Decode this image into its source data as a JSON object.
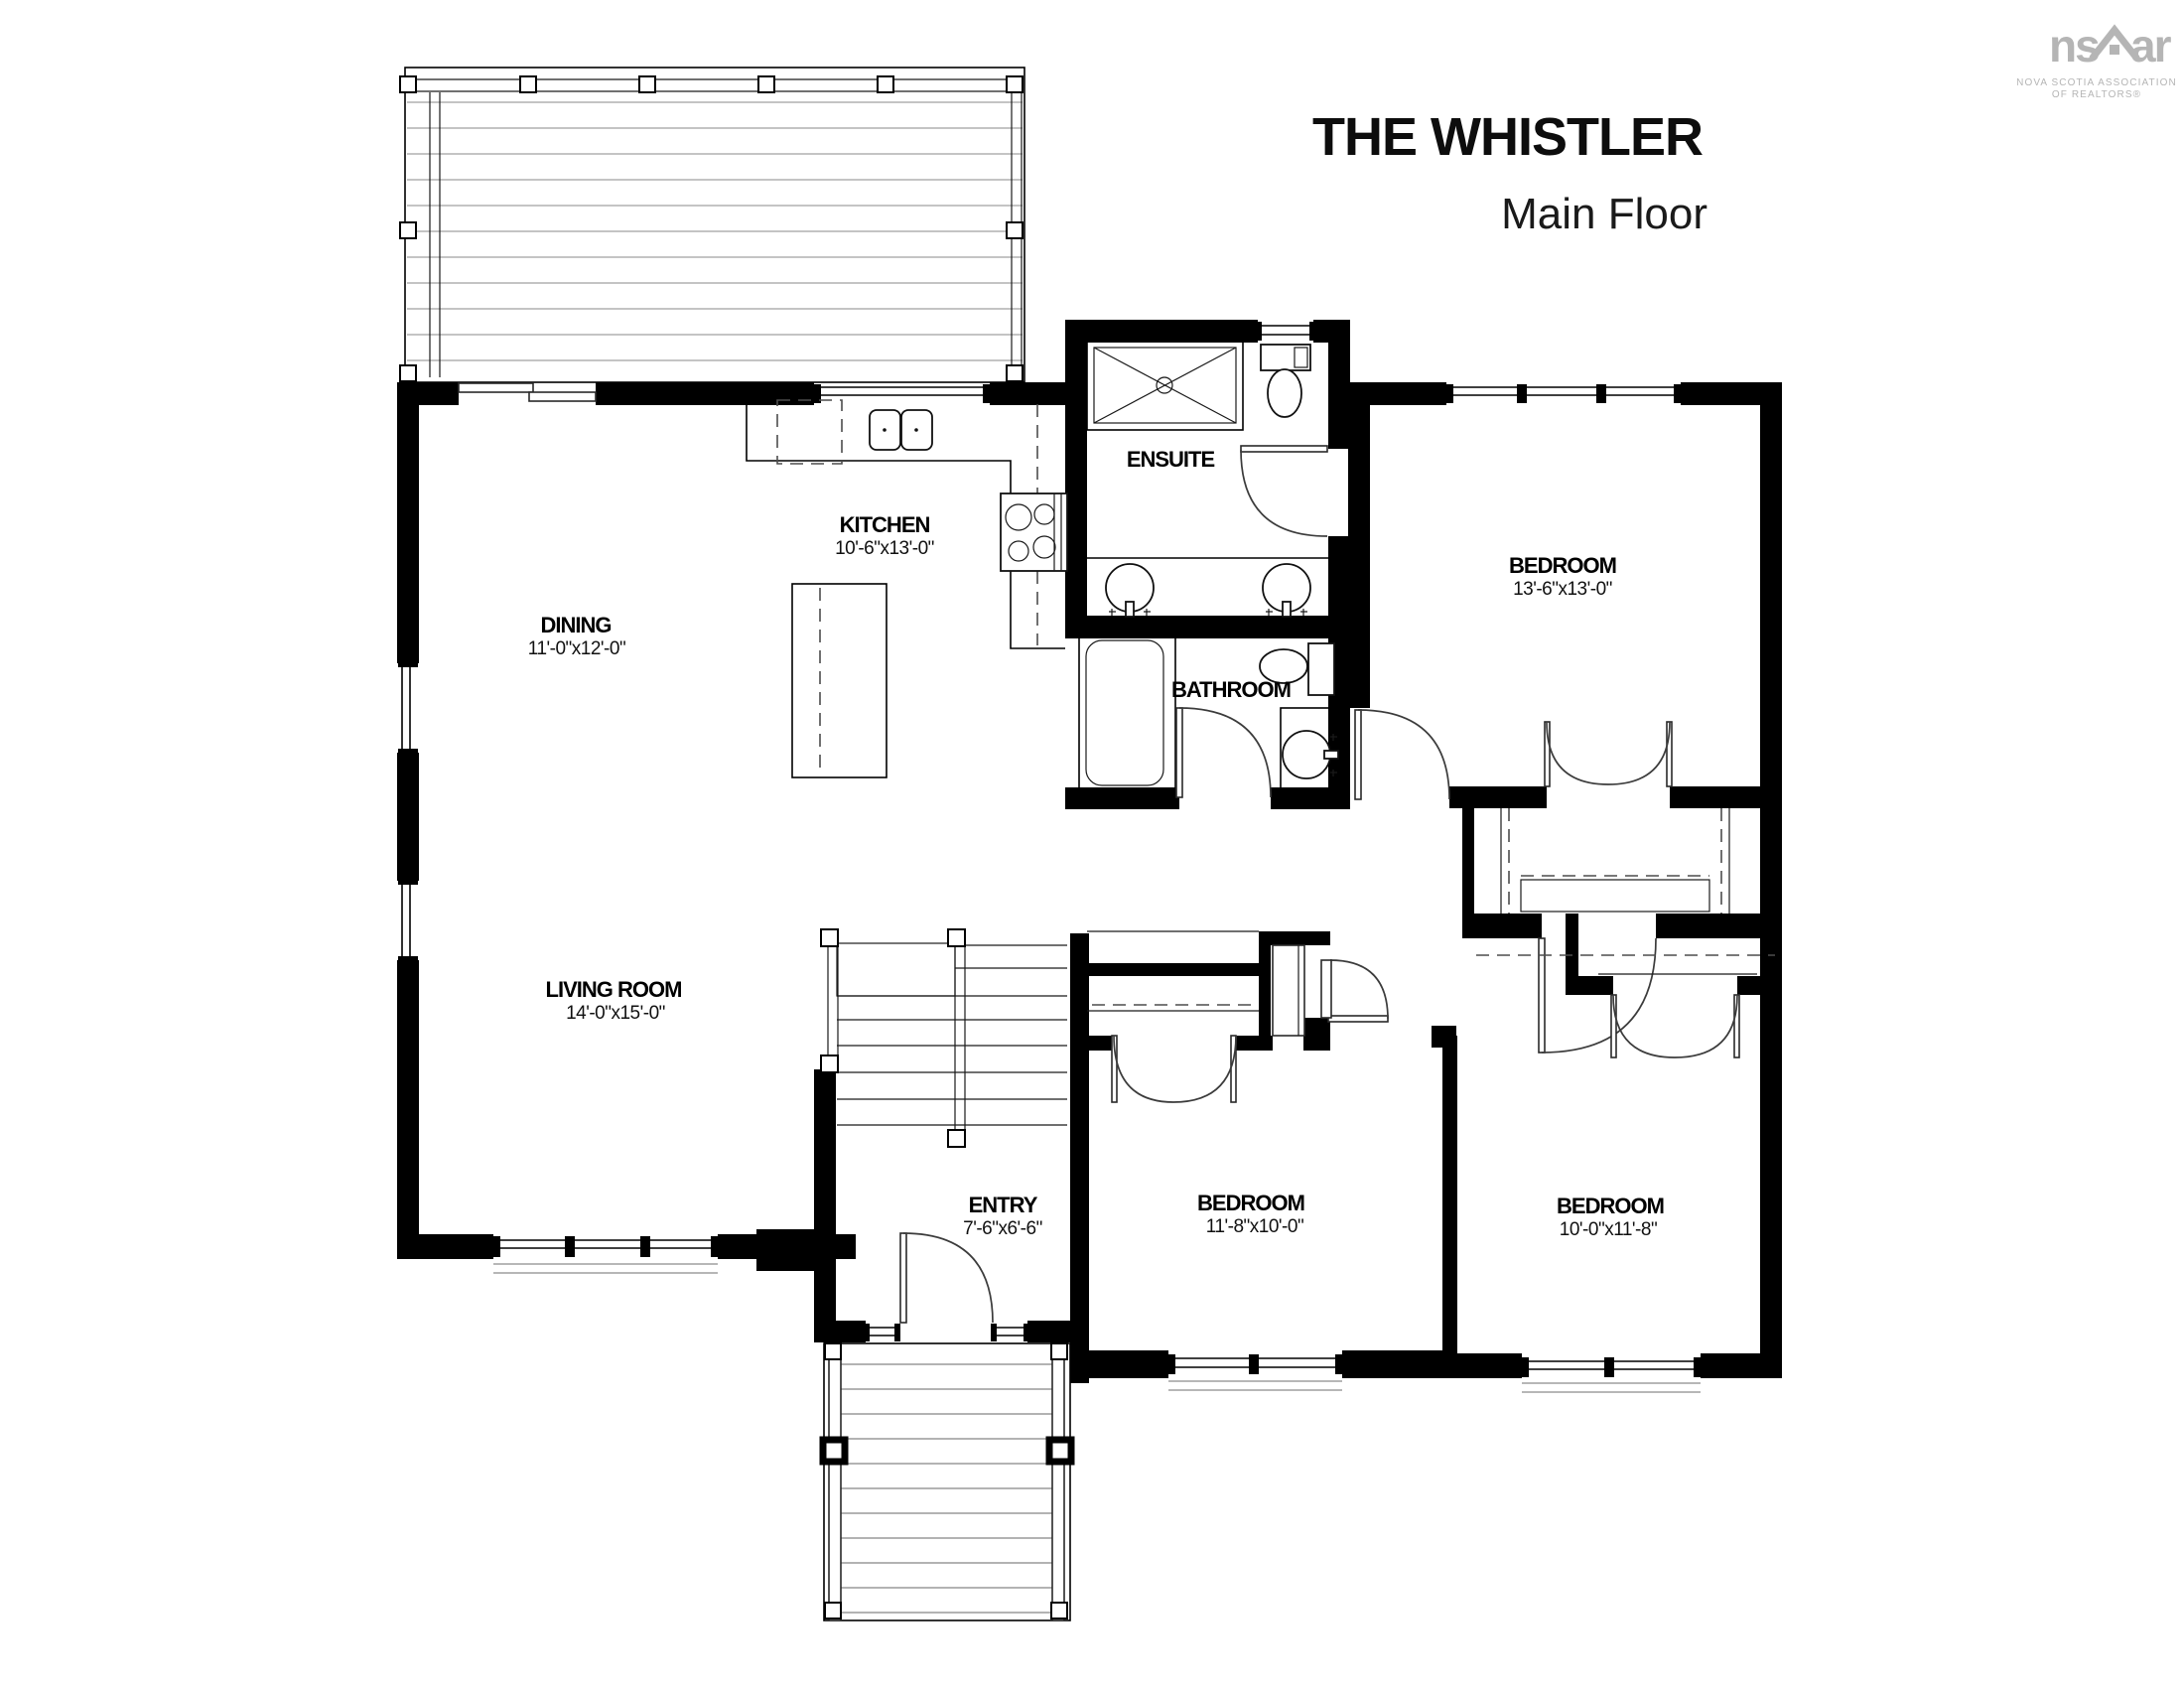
{
  "header": {
    "title": "THE WHISTLER",
    "subtitle": "Main Floor"
  },
  "logo": {
    "brand_left": "ns",
    "brand_right": "ar",
    "tagline_line1": "NOVA SCOTIA ASSOCIATION",
    "tagline_line2": "OF REALTORS®",
    "color": "#b5b5b5"
  },
  "rooms": {
    "dining": {
      "name": "DINING",
      "dims": "11'-0\"x12'-0\""
    },
    "kitchen": {
      "name": "KITCHEN",
      "dims": "10'-6\"x13'-0\""
    },
    "ensuite": {
      "name": "ENSUITE",
      "dims": ""
    },
    "bathroom": {
      "name": "BATHROOM",
      "dims": ""
    },
    "bedroom_master": {
      "name": "BEDROOM",
      "dims": "13'-6\"x13'-0\""
    },
    "living_room": {
      "name": "LIVING ROOM",
      "dims": "14'-0\"x15'-0\""
    },
    "entry": {
      "name": "ENTRY",
      "dims": "7'-6\"x6'-6\""
    },
    "bedroom_center": {
      "name": "BEDROOM",
      "dims": "11'-8\"x10'-0\""
    },
    "bedroom_right": {
      "name": "BEDROOM",
      "dims": "10'-0\"x11'-8\""
    }
  },
  "colors": {
    "walls": "#000000",
    "background": "#ffffff",
    "deck_lines": "#b0b0b0"
  }
}
